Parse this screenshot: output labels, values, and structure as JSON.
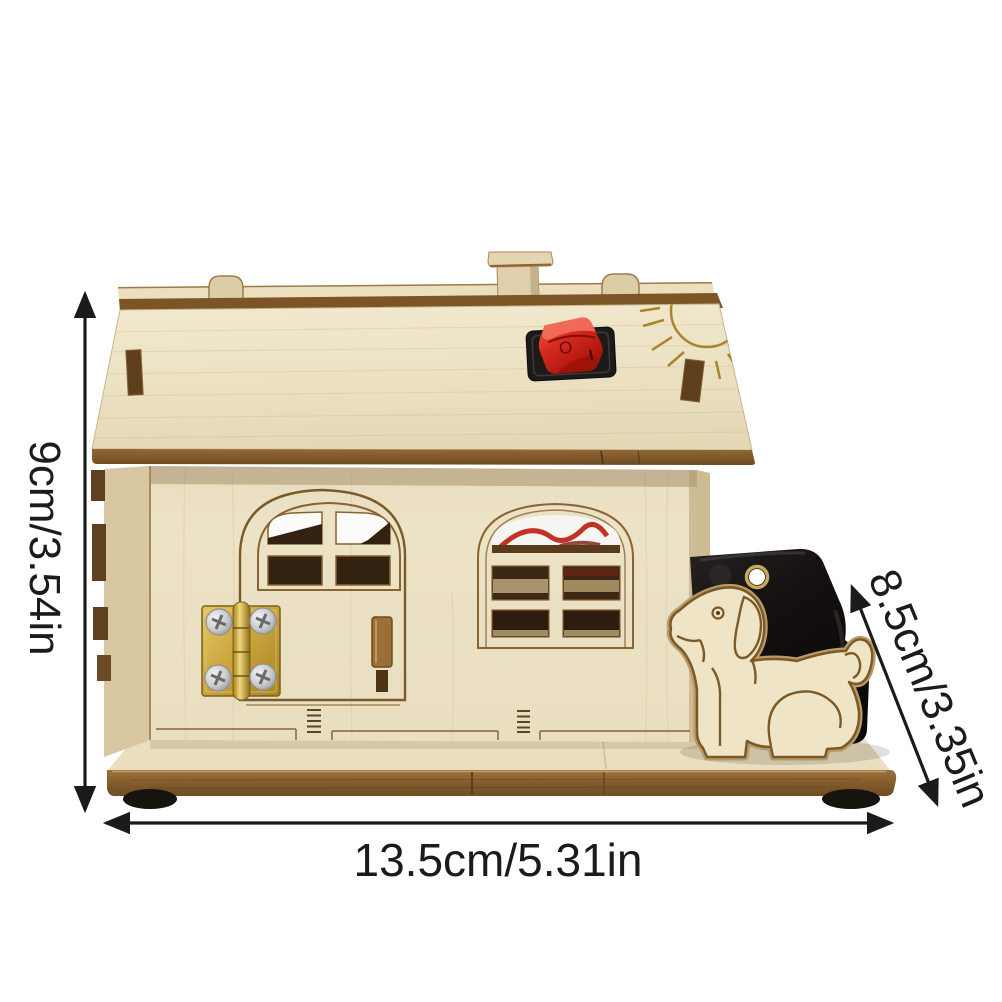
{
  "photo": {
    "background": "#ffffff",
    "subject": "Wooden DIY dog-house science kit with red rocker switch, brass-hinged door, arched windows, plywood dog cutout and black battery box on a wooden base"
  },
  "annotations": {
    "height_label": "9cm/3.54in",
    "width_label": "13.5cm/5.31in",
    "depth_label": "8.5cm/3.35in",
    "ink_color": "#1b1b1b"
  },
  "switch_markings": {
    "off": "O",
    "on": "I"
  },
  "palette": {
    "wood_light": "#efe6cb",
    "wood_mid": "#ddcfa8",
    "edge_brown": "#8a6332",
    "engraving_brown": "#7c5a28",
    "opening_dark": "#32220f",
    "switch_red": "#d5291e",
    "bezel_black": "#1d1b19",
    "battery_box_black": "#141110",
    "brass": "#c8a43c",
    "screw_silver": "#c6c8ca"
  },
  "icons": {
    "sun": "sun-engraving",
    "dog": "dog-cutout-figure",
    "dimension_arrows": "double-headed-arrow"
  }
}
